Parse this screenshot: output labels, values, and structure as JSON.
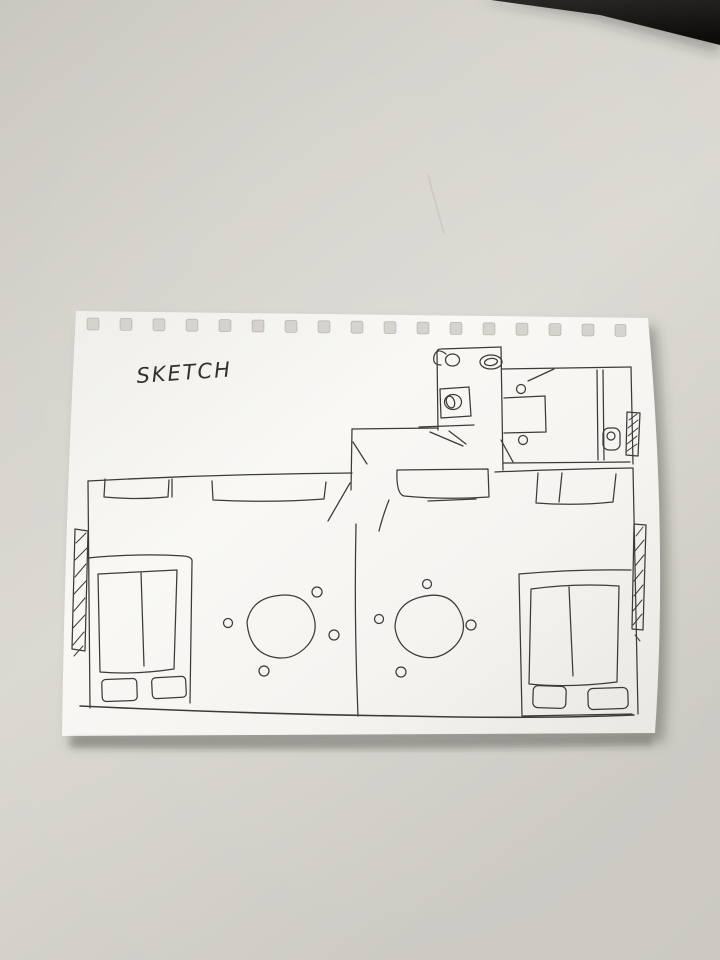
{
  "scene": {
    "kind": "photo-of-hand-drawn-floor-plan-sketch",
    "title_label": "SKETCH"
  },
  "colors": {
    "desk_surface": "#d6d4cd",
    "paper": "#f8f7f4",
    "ink": "#3d3b38",
    "paper_shadow": "rgba(60,57,50,0.38)",
    "dark_corner_object": "#1a1918"
  },
  "notebook_page": {
    "punch_hole_count": 17,
    "hole_shape": "square"
  },
  "floorplan": {
    "rooms": [
      {
        "name": "bathroom-top",
        "fixtures": [
          "toilet",
          "sink",
          "shower-tray"
        ]
      },
      {
        "name": "bedroom-top-right",
        "fixtures": [
          "side-table",
          "stool",
          "stool",
          "wardrobe",
          "window-hatch",
          "washbasin-fixture"
        ]
      },
      {
        "name": "entry-alcove",
        "fixtures": [
          "counter",
          "door-swing",
          "door-leaf",
          "door-leaf"
        ]
      },
      {
        "name": "studio-left",
        "fixtures": [
          "window-hatch-left",
          "wall-window",
          "wall-window",
          "double-bed",
          "pillow",
          "pillow",
          "round-table",
          "chair",
          "chair",
          "chair",
          "chair"
        ]
      },
      {
        "name": "studio-right",
        "fixtures": [
          "wall-window",
          "wall-window",
          "double-bed",
          "pillow",
          "pillow",
          "round-table",
          "chair",
          "chair",
          "chair",
          "chair",
          "window-hatch-right"
        ]
      }
    ]
  }
}
